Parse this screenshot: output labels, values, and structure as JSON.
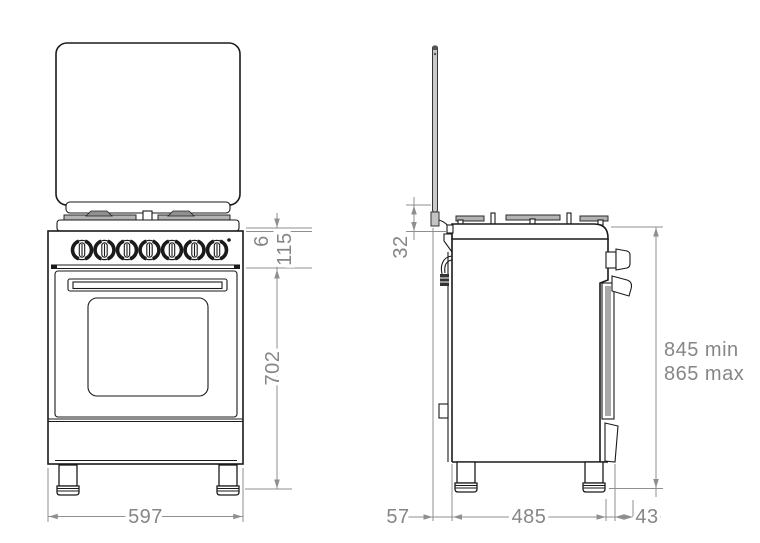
{
  "front_view": {
    "dims": {
      "grate_height": "6",
      "panel_height": "115",
      "body_height": "702",
      "width": "597"
    }
  },
  "side_view": {
    "dims": {
      "lid_to_hob": "32",
      "height_min": "845 min",
      "height_max": "865 max",
      "rear_gap": "57",
      "depth": "485",
      "handle_offset": "43"
    }
  },
  "colors": {
    "object_line": "#1a1a1a",
    "dimension": "#868686",
    "background": "#ffffff"
  }
}
